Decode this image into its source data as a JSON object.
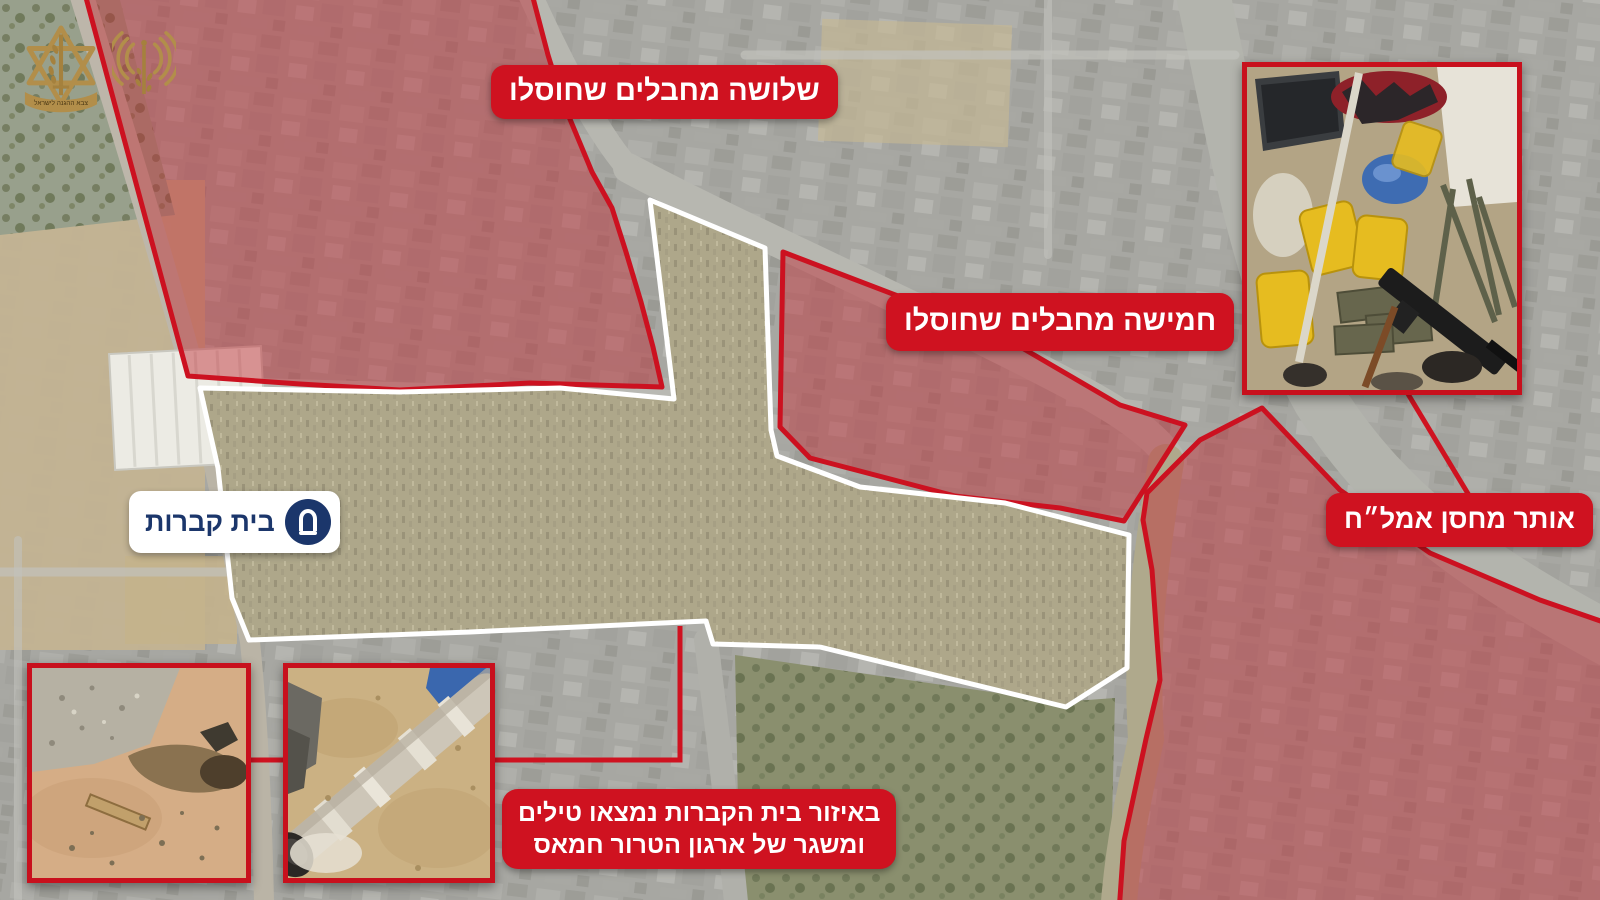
{
  "meta": {
    "description": "Annotated aerial operations map graphic with Hebrew military annotations",
    "language": "he"
  },
  "logos": {
    "idf_emblem_name": "idf-emblem",
    "spokesperson_emblem_name": "idf-spokesperson-emblem",
    "idf_banner_text": "צבא ההגנה לישראל"
  },
  "annotations": {
    "zone_top_left_label": "שלושה מחבלים שחוסלו",
    "zone_middle_label": "חמישה מחבלים שחוסלו",
    "weapons_depot_label": "אותר מחסן אמל״ח",
    "cemetery_label": "בית קברות",
    "bottom_caption_line1": "באיזור בית הקברות נמצאו טילים",
    "bottom_caption_line2": "ומשגר של ארגון הטרור חמאס"
  },
  "photos": [
    {
      "name": "weapons-cache-photo"
    },
    {
      "name": "impact-crater-photo"
    },
    {
      "name": "buried-rocket-photo"
    }
  ],
  "map_features": {
    "marked_zones": [
      "zone-top-left-eliminated",
      "zone-middle-eliminated",
      "zone-right-weapons-depot"
    ],
    "cemetery_outline": "cemetery-white-polygon"
  },
  "colors": {
    "annotation_red": "#cf1220",
    "zone_border_red": "#cc1120",
    "zone_tint": "#c03038",
    "cemetery_navy": "#1b366b",
    "outline_white": "#ffffff",
    "gold_emblem": "#b28e4a"
  }
}
